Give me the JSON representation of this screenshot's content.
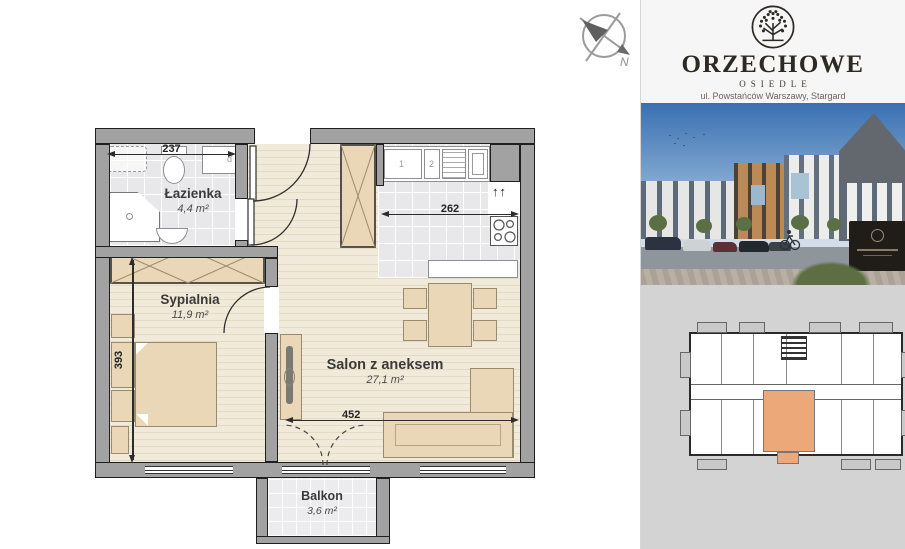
{
  "colors": {
    "wall": "#a2a2a2",
    "wall-line": "#1f1f1f",
    "wood-floor": "#f1eada",
    "wood-stripe": "#e3dac2",
    "tile": "#e8e8ea",
    "furniture": "#ead7b8",
    "furniture-line": "#9a8a6e",
    "highlight-unit": "#eca878",
    "locator-bg": "#d3d3d4",
    "brand-dark": "#2e2923"
  },
  "plan": {
    "compass": {
      "label": "N"
    },
    "rooms": [
      {
        "name": "Łazienka",
        "area": "4,4 m²"
      },
      {
        "name": "Sypialnia",
        "area": "11,9 m²"
      },
      {
        "name": "Salon z aneksem",
        "area": "27,1 m²"
      },
      {
        "name": "Balkon",
        "area": "3,6 m²"
      }
    ],
    "dimensions": [
      {
        "label": "237"
      },
      {
        "label": "262"
      },
      {
        "label": "393"
      },
      {
        "label": "452"
      }
    ],
    "annotations": {
      "cabinet": "d",
      "counter1": "1",
      "counter2": "2",
      "vent": "↑↑"
    }
  },
  "sidebar": {
    "logo": {
      "title": "ORZECHOWE",
      "subtitle": "OSIEDLE",
      "address": "ul. Powstańców Warszawy, Stargard"
    }
  }
}
